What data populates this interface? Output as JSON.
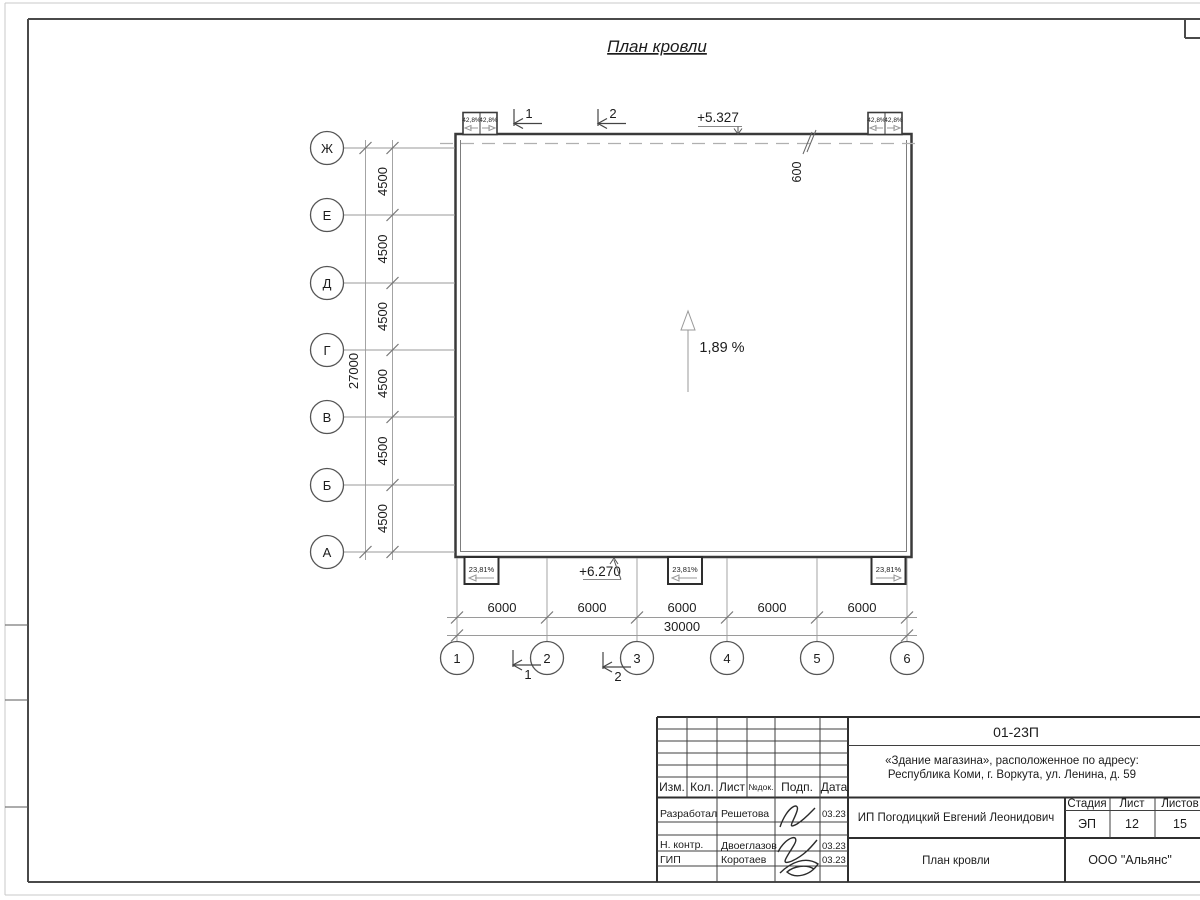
{
  "page": {
    "title": "План кровли"
  },
  "plan": {
    "slope_label": "1,89 %",
    "elevation_top": "+5.327",
    "elevation_bottom": "+6.270",
    "offset_label": "600",
    "row_axes": [
      "Ж",
      "Е",
      "Д",
      "Г",
      "В",
      "Б",
      "А"
    ],
    "col_axes": [
      "1",
      "2",
      "3",
      "4",
      "5",
      "6"
    ],
    "dim_row_spacing": [
      "4500",
      "4500",
      "4500",
      "4500",
      "4500",
      "4500"
    ],
    "dim_row_total": "27000",
    "dim_col_spacing": [
      "6000",
      "6000",
      "6000",
      "6000",
      "6000"
    ],
    "dim_col_total": "30000",
    "funnels_top": [
      "42,8%",
      "42,8%",
      "42,8%",
      "42,8%"
    ],
    "funnels_bottom": [
      "23,81%",
      "23,81%",
      "23,81%"
    ],
    "section_marks": [
      "1",
      "2"
    ]
  },
  "title_block": {
    "code": "01-23П",
    "address_line1": "«Здание магазина», расположенное по адресу:",
    "address_line2": "Республика Коми, г. Воркута, ул. Ленина, д. 59",
    "columns": {
      "izm": "Изм.",
      "kol": "Кол.",
      "list": "Лист",
      "ndok": "№док.",
      "podp": "Подп.",
      "data": "Дата"
    },
    "rows": [
      {
        "role": "Разработал",
        "name": "Решетова",
        "date": "03.23"
      },
      {
        "role": "Н. контр.",
        "name": "Двоеглазов",
        "date": "03.23"
      },
      {
        "role": "ГИП",
        "name": "Коротаев",
        "date": "03.23"
      }
    ],
    "client": "ИП Погодицкий Евгений Леонидович",
    "doc_title": "План кровли",
    "stage_label": "Стадия",
    "stage": "ЭП",
    "sheet_label": "Лист",
    "sheet": "12",
    "sheets_label": "Листов",
    "sheets": "15",
    "company": "ООО \"Альянс\""
  },
  "colors": {
    "line_dark": "#3f3f3f",
    "line_light": "#9a9a9a",
    "text": "#1c1c1c"
  }
}
